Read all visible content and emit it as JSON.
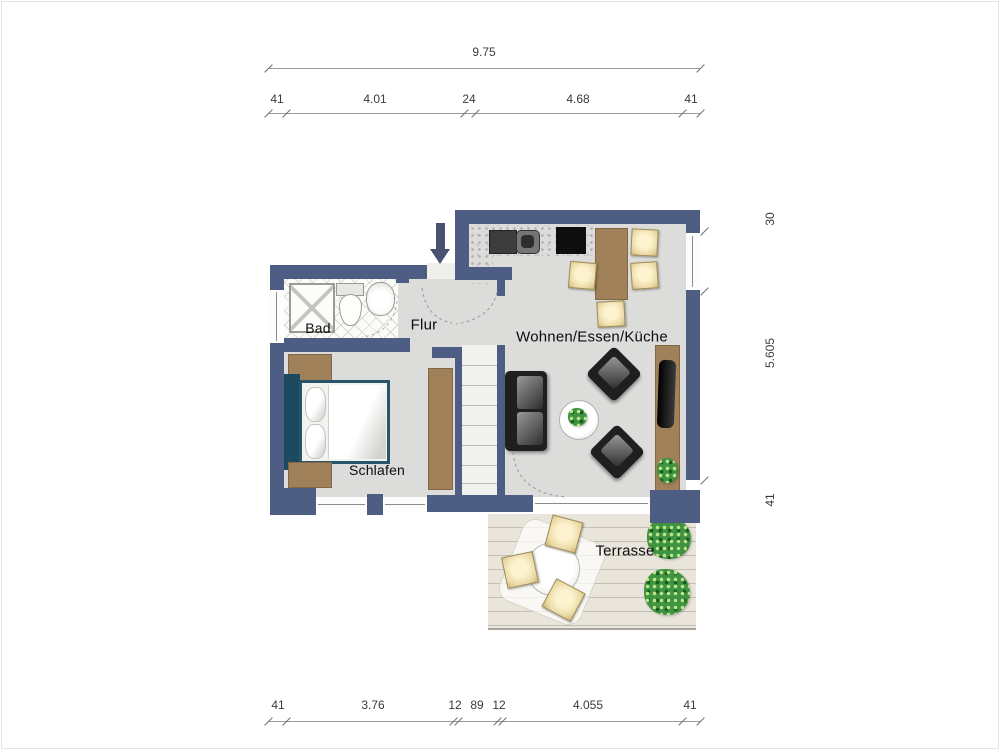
{
  "title": "Apartment floor plan",
  "rooms": {
    "bad": "Bad",
    "flur": "Flur",
    "wohnen": "Wohnen/Essen/Küche",
    "schlafen": "Schlafen",
    "terrasse": "Terrasse"
  },
  "dims": {
    "total_width": "9.75",
    "top": [
      "41",
      "4.01",
      "24",
      "4.68",
      "41"
    ],
    "right": [
      "30",
      "5.605",
      "41"
    ],
    "bottom": [
      "41",
      "3.76",
      "12",
      "89",
      "12",
      "4.055",
      "41"
    ]
  },
  "colors": {
    "wall": "#4e5d84",
    "floor": "#dcdcda",
    "wood": "#a1815a",
    "chair": "#ead9a4",
    "bedframe": "#27566b",
    "headboard": "#1d4a5e",
    "plant": "#3e9440",
    "deck": "#e9e5db",
    "arrow": "#49536f"
  }
}
